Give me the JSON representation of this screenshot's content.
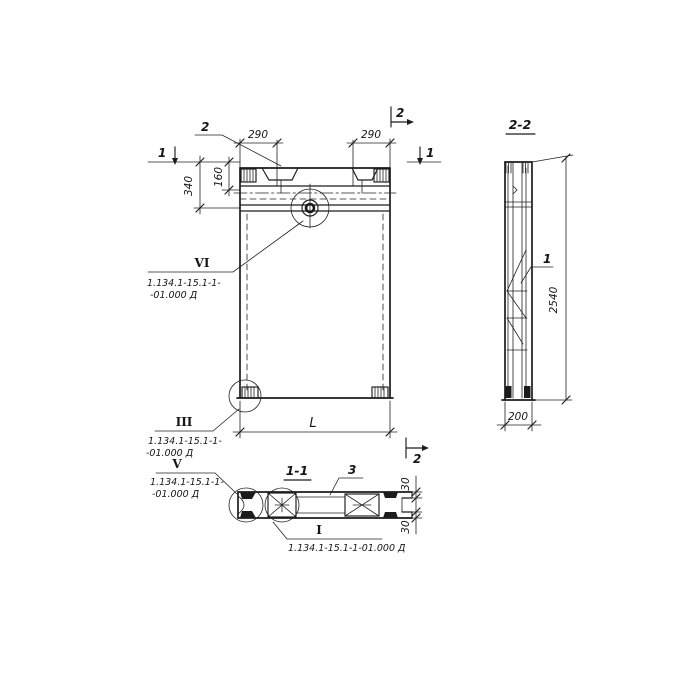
{
  "front": {
    "mark_1_left": "1",
    "mark_1_right": "1",
    "mark_2_top": "2",
    "mark_2_bottom": "2",
    "part_2": "2",
    "dim_290_left": "290",
    "dim_290_right": "290",
    "dim_340": "340",
    "dim_160": "160",
    "dim_L": "L",
    "callout_vi": {
      "numeral": "VI",
      "line1": "1.134.1-15.1-1-",
      "line2": "-01.000 Д"
    },
    "callout_iii": {
      "numeral": "III",
      "line1": "1.134.1-15.1-1-",
      "line2": "-01.000 Д"
    }
  },
  "side": {
    "title": "2-2",
    "part_1": "1",
    "dim_2540": "2540",
    "dim_200": "200"
  },
  "plan": {
    "title": "1-1",
    "part_3": "3",
    "dim_30_top": "30",
    "dim_30_bottom": "30",
    "callout_v": {
      "numeral": "V",
      "line1": "1.134.1-15.1-1-",
      "line2": "-01.000 Д"
    },
    "callout_i": {
      "numeral": "I",
      "line1": "1.134.1-15.1-1-01.000 Д"
    }
  },
  "colors": {
    "ink": "#1c1c1c",
    "paper": "#ffffff"
  }
}
